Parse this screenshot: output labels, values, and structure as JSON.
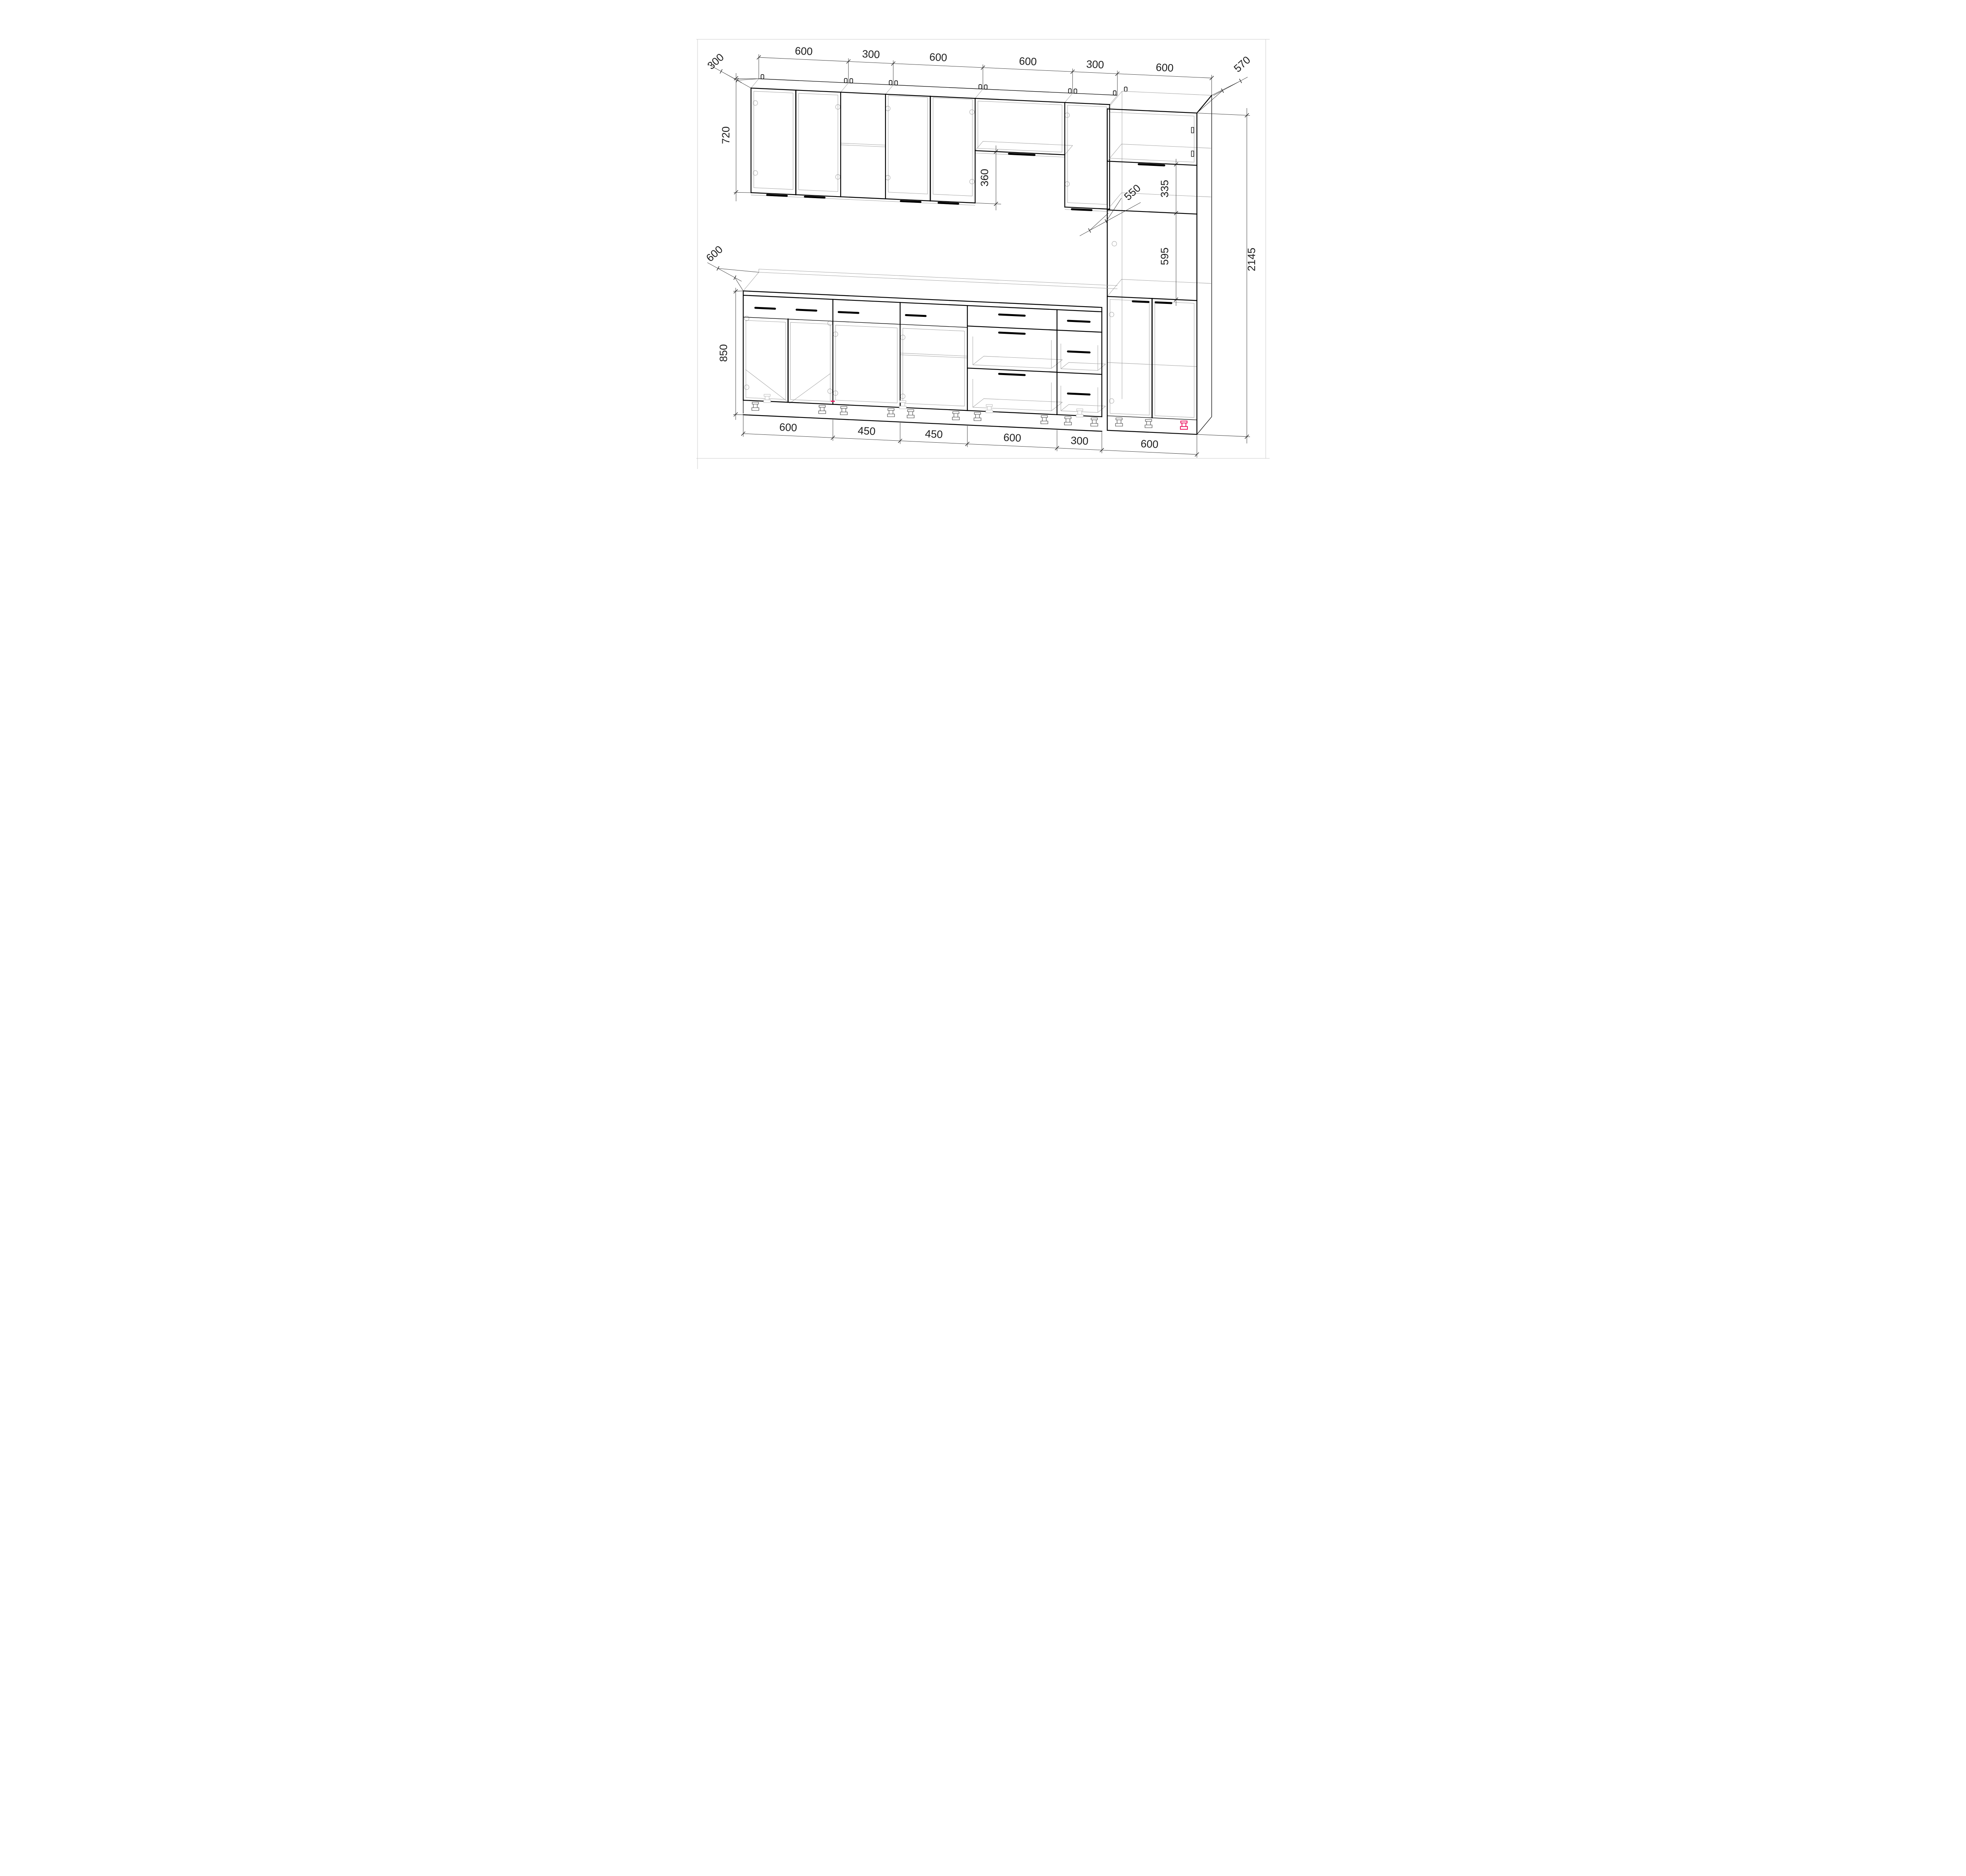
{
  "drawing": {
    "type": "kitchen-cabinet-elevation",
    "units": "mm",
    "accent_color": "#ec1a63",
    "top_dims": [
      "600",
      "300",
      "600",
      "600",
      "300",
      "600"
    ],
    "bottom_dims": [
      "600",
      "450",
      "450",
      "600",
      "300",
      "600"
    ],
    "side_dims": {
      "wall_cabinet_depth": "300",
      "wall_cabinet_height": "720",
      "hood_gap_height": "360",
      "base_depth": "600",
      "base_height": "850",
      "tall_depth": "570",
      "tall_shelf_gap": "335",
      "tall_interior_depth": "550",
      "oven_niche_height": "595",
      "tall_height": "2145"
    }
  }
}
